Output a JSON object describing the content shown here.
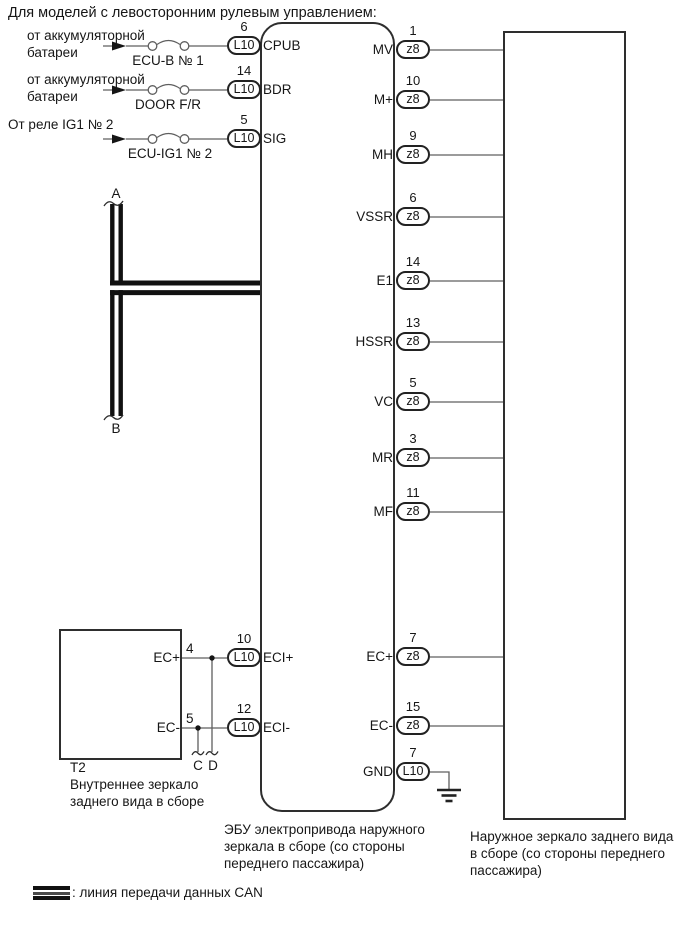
{
  "title": "Для моделей с левосторонним рулевым управлением:",
  "power_inputs": [
    {
      "source_line1": "от аккумуляторной",
      "source_line2": "батареи",
      "fuse": "ECU-B № 1",
      "pin": "6",
      "connector": "L10",
      "signal": "CPUB"
    },
    {
      "source_line1": "от аккумуляторной",
      "source_line2": "батареи",
      "fuse": "DOOR F/R",
      "pin": "14",
      "connector": "L10",
      "signal": "BDR"
    },
    {
      "source_line1": "От реле IG1 № 2",
      "source_line2": "",
      "fuse": "ECU-IG1 № 2",
      "pin": "5",
      "connector": "L10",
      "signal": "SIG"
    }
  ],
  "can_bus": {
    "top_label": "A",
    "bottom_label": "B"
  },
  "ecu_box": {
    "caption_line1": "ЭБУ электропривода наружного",
    "caption_line2": "зеркала в сборе (со стороны",
    "caption_line3": "переднего пассажира)"
  },
  "right_pins": [
    {
      "name": "MV",
      "pin": "1",
      "connector": "z8"
    },
    {
      "name": "M+",
      "pin": "10",
      "connector": "z8"
    },
    {
      "name": "MH",
      "pin": "9",
      "connector": "z8"
    },
    {
      "name": "VSSR",
      "pin": "6",
      "connector": "z8"
    },
    {
      "name": "E1",
      "pin": "14",
      "connector": "z8"
    },
    {
      "name": "HSSR",
      "pin": "13",
      "connector": "z8"
    },
    {
      "name": "VC",
      "pin": "5",
      "connector": "z8"
    },
    {
      "name": "MR",
      "pin": "3",
      "connector": "z8"
    },
    {
      "name": "MF",
      "pin": "11",
      "connector": "z8"
    },
    {
      "name": "EC+",
      "pin": "7",
      "connector": "z8"
    },
    {
      "name": "EC-",
      "pin": "15",
      "connector": "z8"
    },
    {
      "name": "GND",
      "pin": "7",
      "connector": "L10"
    }
  ],
  "outer_mirror_box": {
    "caption_line1": "Наружное зеркало заднего вида",
    "caption_line2": "в сборе (со стороны переднего",
    "caption_line3": "пассажира)"
  },
  "inner_mirror_box": {
    "label": "T2",
    "caption_line1": "Внутреннее зеркало",
    "caption_line2": "заднего вида в сборе",
    "rows": [
      {
        "t2_signal": "EC+",
        "t2_pin": "4",
        "pin": "10",
        "connector": "L10",
        "signal": "ECI+",
        "branch_label": "D"
      },
      {
        "t2_signal": "EC-",
        "t2_pin": "5",
        "pin": "12",
        "connector": "L10",
        "signal": "ECI-",
        "branch_label": "C"
      }
    ]
  },
  "legend": {
    "label": ": линия передачи данных CAN"
  }
}
